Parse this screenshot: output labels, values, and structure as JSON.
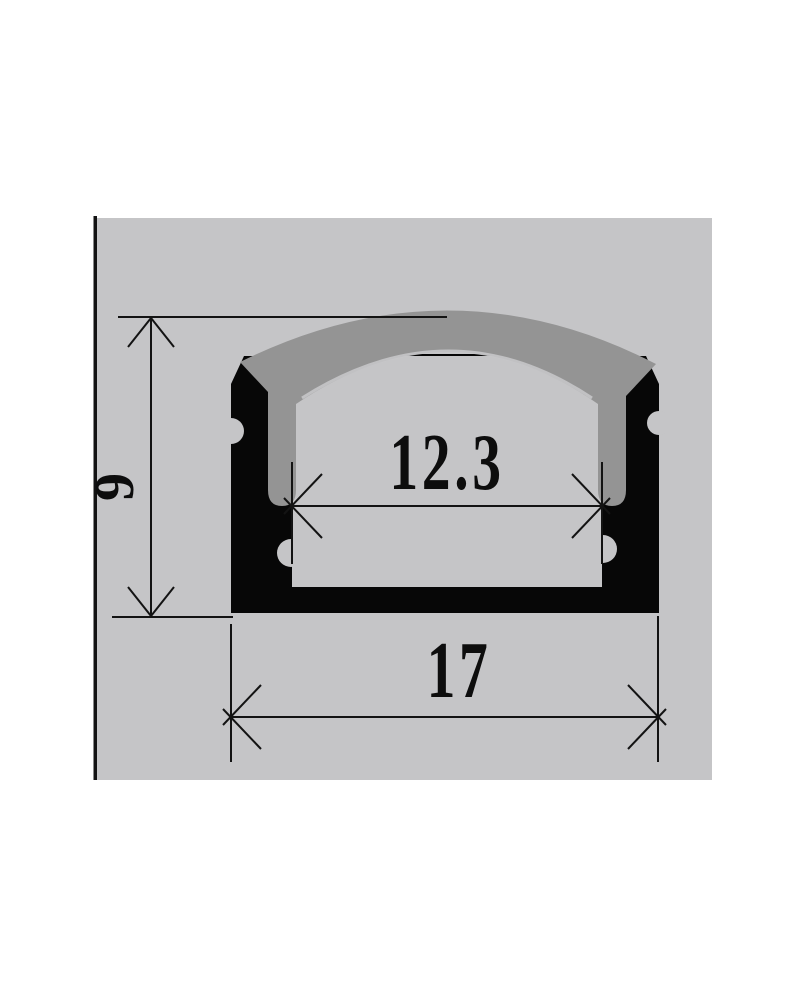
{
  "drawing": {
    "type": "technical-cross-section",
    "subject": "aluminum-led-profile-channel-with-diffuser-cover",
    "dimensions": {
      "height": {
        "label": "9"
      },
      "inner_width": {
        "label": "12.3"
      },
      "outer_width": {
        "label": "17"
      }
    },
    "colors": {
      "page_background": "#ffffff",
      "panel": "#c5c5c7",
      "profile_body": "#070707",
      "cover": "#949494",
      "cover_highlight": "#c9c9cb",
      "line": "#131313",
      "text": "#0d0d0d"
    }
  }
}
